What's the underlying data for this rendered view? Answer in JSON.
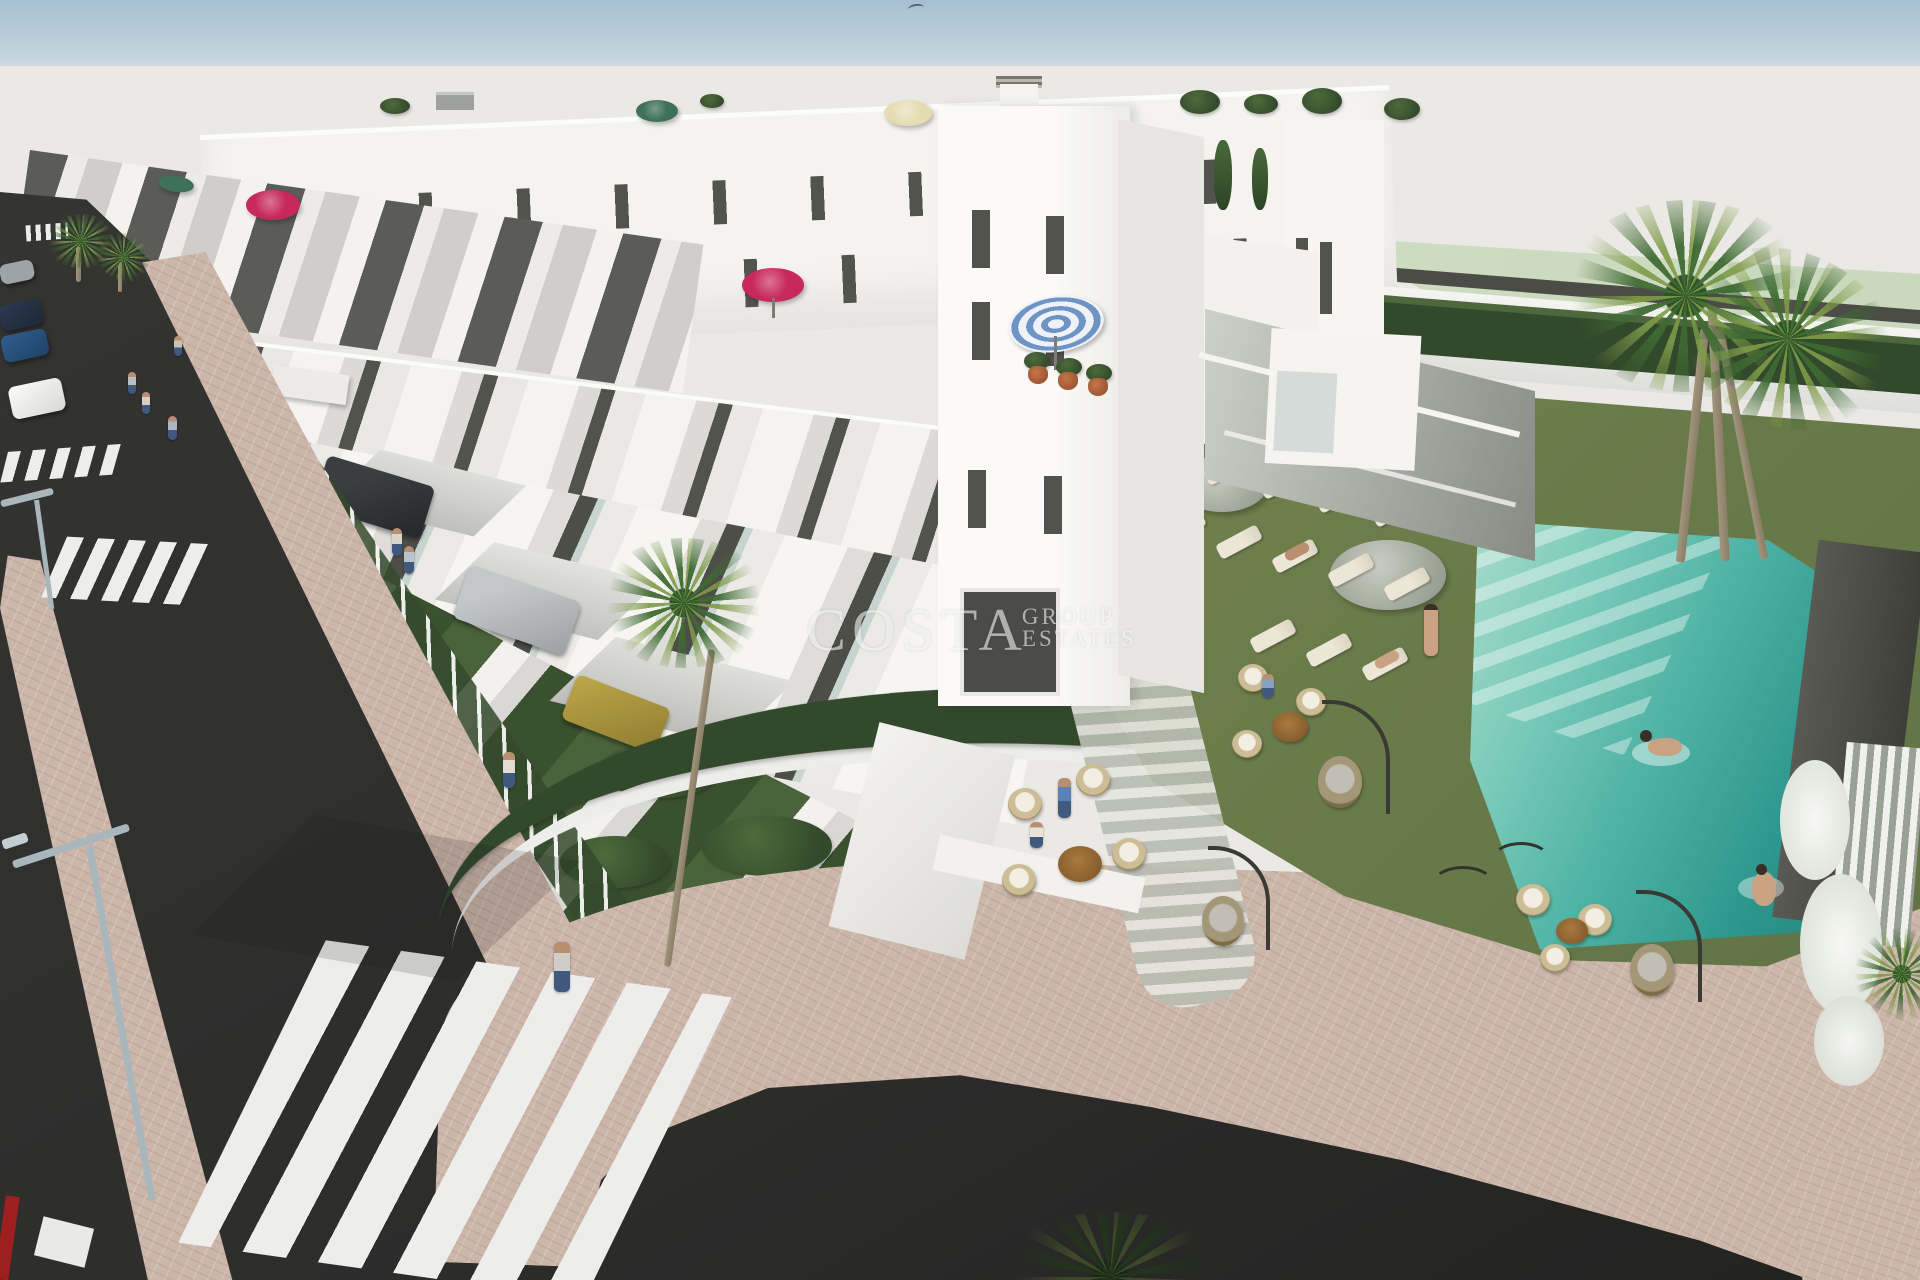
{
  "watermark": {
    "brand": "COSTA",
    "word_group": "GROUP",
    "word_estates": "ESTATES"
  },
  "palette": {
    "sky-top": "#a6c0d1",
    "sky-horizon": "#c9d7de",
    "backdrop": "#ebe9e5",
    "building-white": "#f4f3f0",
    "building-shade": "#d9d8d4",
    "panel-dark": "#53534e",
    "mint": "#d6e2cc",
    "lawn": "#71814e",
    "hedge": "#33492b",
    "pool-shallow": "#9fd8c6",
    "pool-deep": "#2b958c",
    "asphalt": "#2d2d2c",
    "paving-pink": "#ccb5a9",
    "curb-white": "#ededeb",
    "umbrella-gray": "#a6ab9f",
    "lounger-cream": "#ece6d6",
    "umbrella-red": "#c8295c",
    "umbrella-green": "#3f7158",
    "umbrella-cream": "#e6dcb4",
    "umbrella-blue": "#6d94c4",
    "car-red": "#c2211d",
    "lamp-gray": "#a9b7bd",
    "palm-green": "#3f6a33",
    "palm-light": "#7d9a48",
    "trunk": "#a2957e",
    "watermark": "#ffffff"
  },
  "scene": {
    "alt": "Aerial 3D render of a white townhouse development with roof terraces, communal lawn, swimming pool, palm trees and surrounding streets"
  }
}
